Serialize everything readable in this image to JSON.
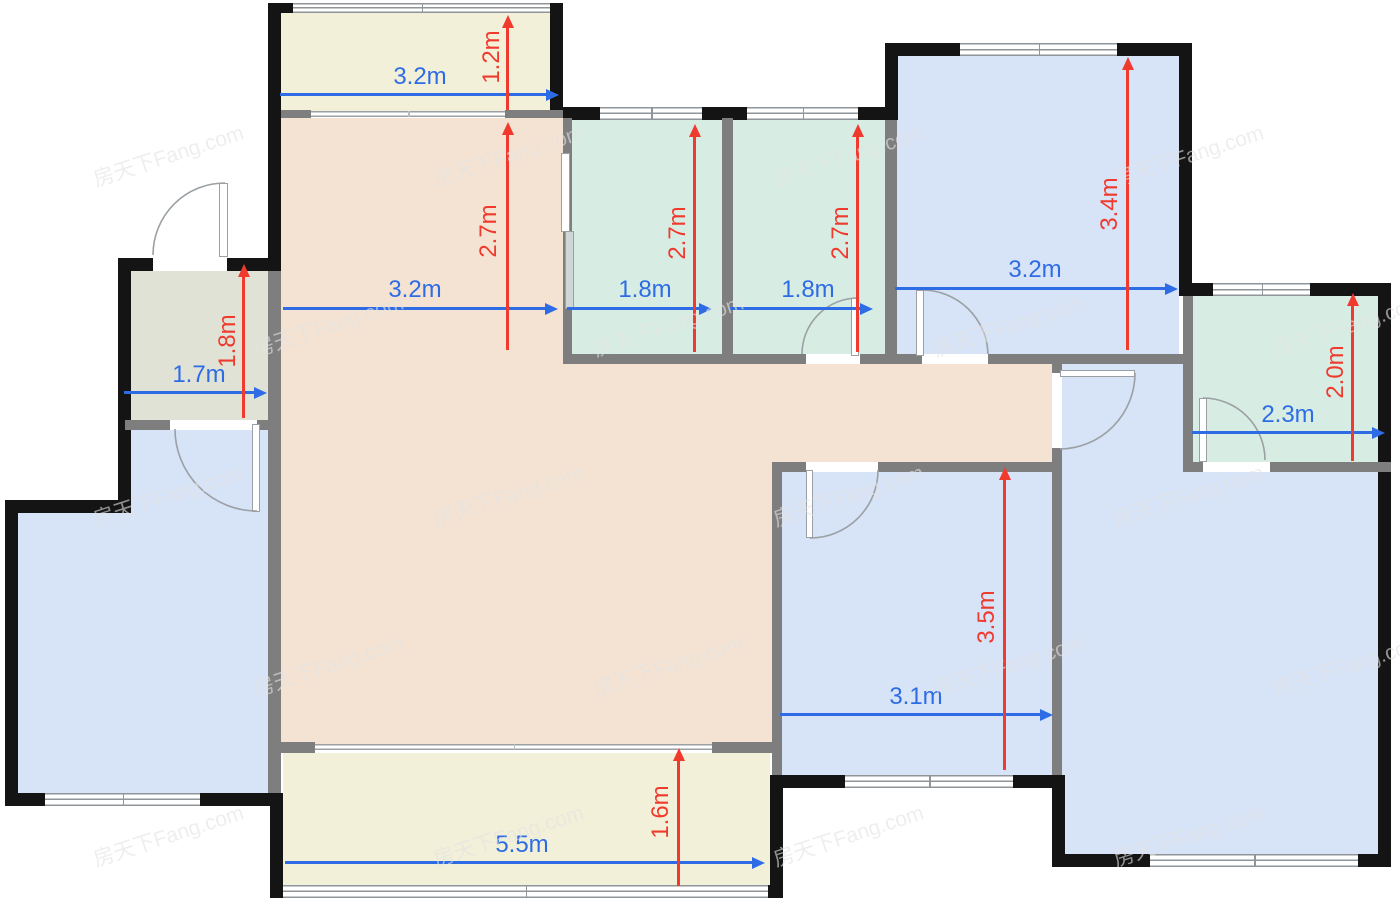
{
  "watermark": {
    "text": "房天下Fang.com"
  },
  "palette": {
    "wall_exterior": "#141414",
    "wall_interior": "#7e7e7e",
    "dim_blue": "#2e6ce6",
    "dim_red": "#f03a2e",
    "room_living": "#f4e3d2",
    "room_balcony": "#f2f0d8",
    "room_teal": "#d7ece3",
    "room_blue": "#d7e3f7",
    "room_utility": "#dfe2d4"
  },
  "dims": {
    "h": [
      {
        "id": "balcony-top-width",
        "label": "3.2m"
      },
      {
        "id": "living-width",
        "label": "3.2m"
      },
      {
        "id": "teal-left-width",
        "label": "1.8m"
      },
      {
        "id": "teal-right-width",
        "label": "1.8m"
      },
      {
        "id": "bedroom-top-right-width",
        "label": "3.2m"
      },
      {
        "id": "utility-width",
        "label": "1.7m"
      },
      {
        "id": "bath-width",
        "label": "2.3m"
      },
      {
        "id": "bedroom-bottom-width",
        "label": "3.1m"
      },
      {
        "id": "balcony-bottom-width",
        "label": "5.5m"
      }
    ],
    "v": [
      {
        "id": "balcony-top-depth",
        "label": "1.2m"
      },
      {
        "id": "living-depth",
        "label": "2.7m"
      },
      {
        "id": "teal-left-depth",
        "label": "2.7m"
      },
      {
        "id": "teal-right-depth",
        "label": "2.7m"
      },
      {
        "id": "bedroom-top-right-depth",
        "label": "3.4m"
      },
      {
        "id": "utility-depth",
        "label": "1.8m"
      },
      {
        "id": "bath-depth",
        "label": "2.0m"
      },
      {
        "id": "bedroom-bottom-depth",
        "label": "3.5m"
      },
      {
        "id": "balcony-bottom-depth",
        "label": "1.6m"
      }
    ]
  }
}
